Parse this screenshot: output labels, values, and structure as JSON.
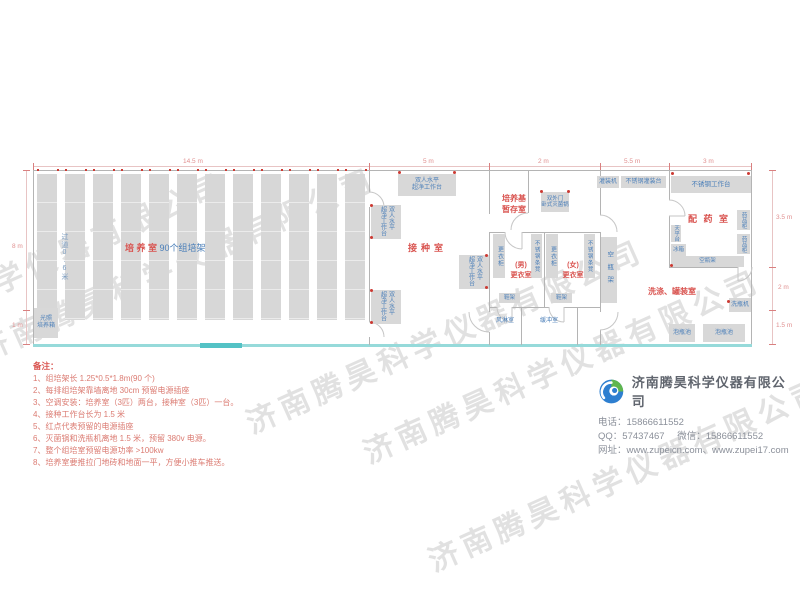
{
  "watermark": "济南腾昊科学仪器有限公司",
  "dims": {
    "top": [
      "14.5 m",
      "5 m",
      "2 m",
      "5.5 m",
      "3 m"
    ],
    "left": [
      "8 m",
      "1 m"
    ],
    "right": [
      "3.5 m",
      "2 m",
      "1.5 m"
    ]
  },
  "rooms": {
    "culture_name": "培 养 室",
    "culture_racks": "90个组培架",
    "aisle": "过道0.6米",
    "incubator1": "光照",
    "incubator2": "培养箱",
    "inoculation": "接种室",
    "bench_line1": "双人水平",
    "bench_line2": "超净工作台",
    "medium1": "培养基",
    "medium2": "暂存室",
    "sterilizer1": "双外门",
    "sterilizer2": "卧式灭菌锅",
    "locker": "更衣柜",
    "ss_bench": "不锈钢条凳",
    "male1": "(男)",
    "male2": "更衣室",
    "female1": "(女)",
    "female2": "更衣室",
    "shoe_rack": "鞋架",
    "air_shower": "风淋室",
    "buffer": "缓冲室",
    "filling_machine": "灌装机",
    "filling_table": "不锈钢灌装台",
    "work_table": "不锈钢工作台",
    "dispensary": "配 药 室",
    "medicine_cabinet": "药品柜",
    "balance_table": "天平台",
    "fridge": "冰箱",
    "bottle_rack": "空瓶架",
    "washing_room": "洗涤、罐装室",
    "bottle_washer": "洗瓶机",
    "soak_pool": "泡瓶池"
  },
  "notes": {
    "title": "备注：",
    "items": [
      "1、组培架长 1.25*0.5*1.8m(90 个)",
      "2、每排组培架靠墙离地 30cm 预留电源插座",
      "3、空调安装：培养室（3匹）两台，接种室（3匹）一台。",
      "4、接种工作台长为 1.5 米",
      "5、红点代表预留的电源插座",
      "6、灭菌锅和洗瓶机离地 1.5 米，预留 380v 电源。",
      "7、整个组培室预留电源功率 >100kw",
      "8、培养室要推拉门地砖和地面一平，方便小推车推送。"
    ]
  },
  "company": {
    "name": "济南腾昊科学仪器有限公司",
    "phone_label": "电话：",
    "phone": "15866611552",
    "qq_label": "QQ：",
    "qq": "57437467",
    "wechat_label": "微信：",
    "wechat": "15866611552",
    "web_label": "网址：",
    "websites": "www.zupeicn.com、www.zupei17.com"
  },
  "colors": {
    "red_label": "#d9534f",
    "blue_label": "#4b7fb9",
    "wall": "#b4b4b4",
    "box_fill": "#d8d8d8",
    "south_wall_cyan": "#96dada",
    "outlet_dot_red": "#cc3a33"
  }
}
